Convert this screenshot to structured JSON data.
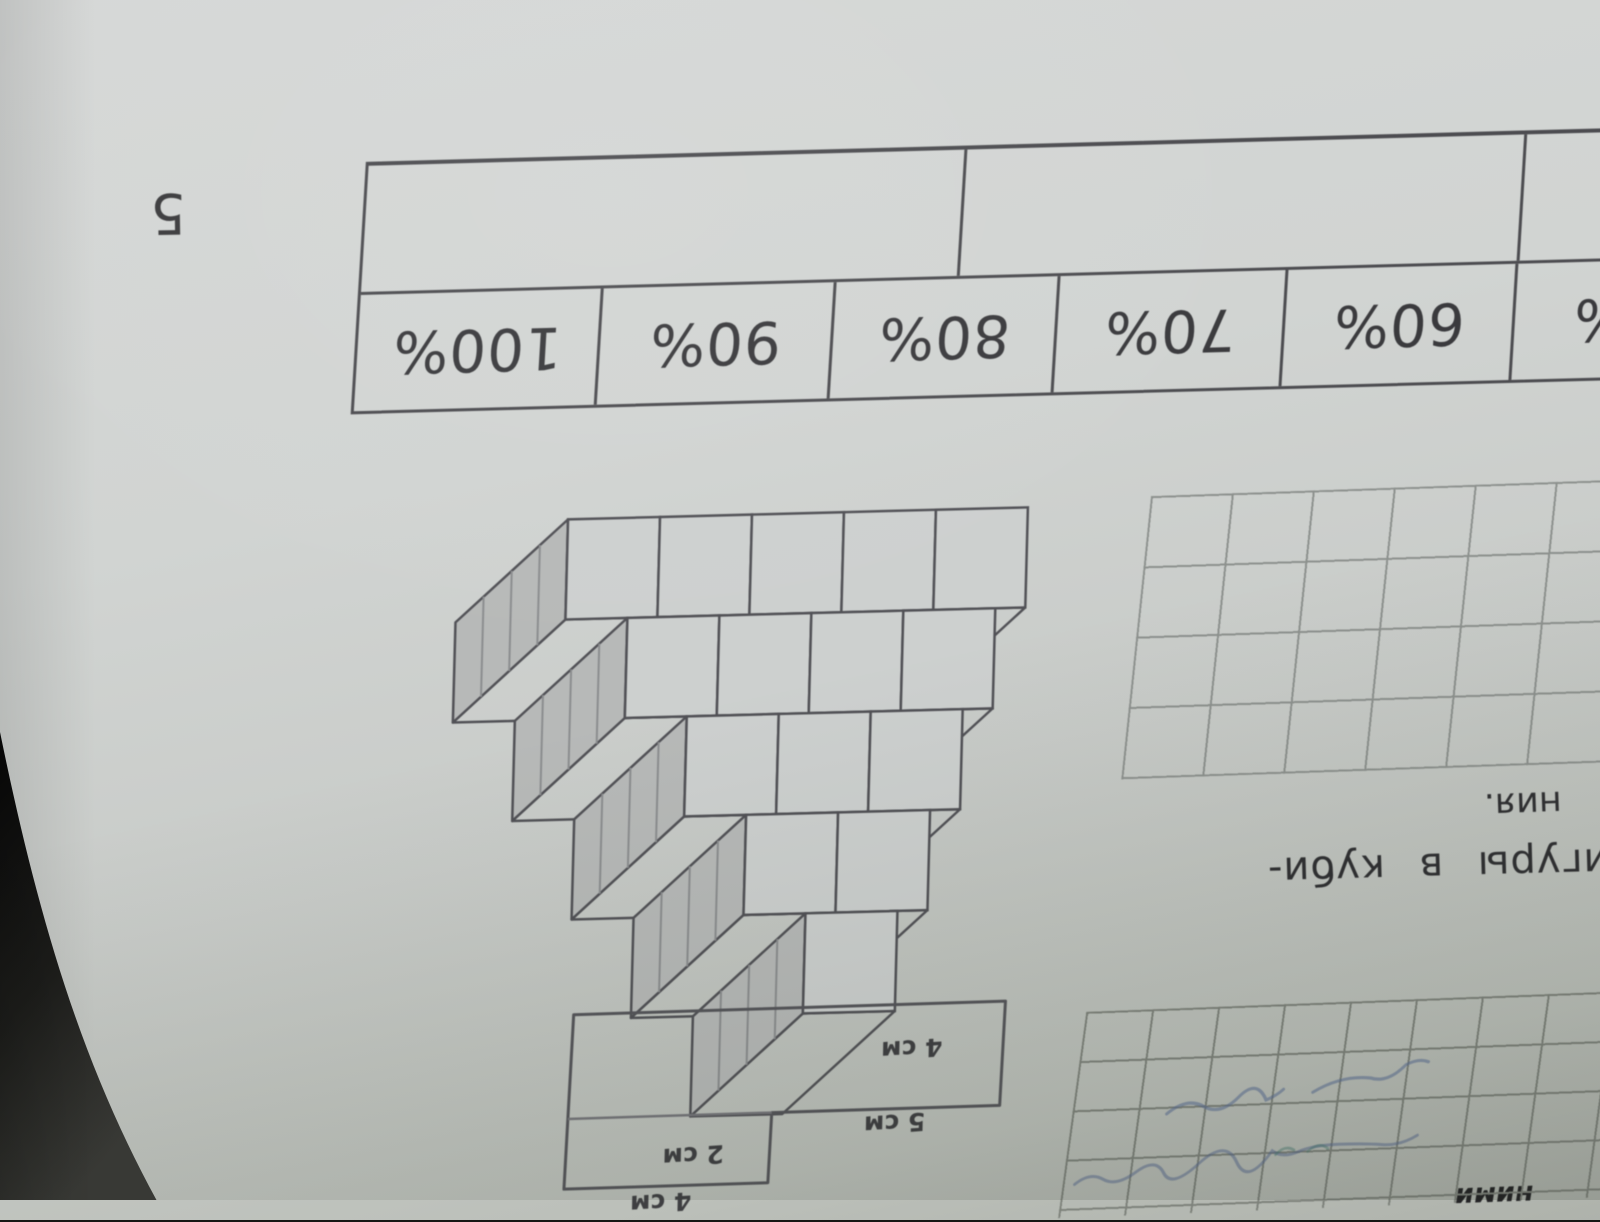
{
  "page": {
    "task_number": "5",
    "table": {
      "header_cells": [
        "",
        "",
        ""
      ],
      "percent_cells": [
        "100%",
        "90%",
        "80%",
        "70%",
        "60%",
        "50%"
      ]
    },
    "cube_figure": {
      "rows_of_cubes": [
        5,
        4,
        3,
        2,
        1
      ]
    },
    "grids": {
      "blank_grid": {
        "cols": 6,
        "rows": 4
      },
      "notebook_grid": {
        "cols": 9,
        "rows": 5
      }
    },
    "text_fragments": {
      "line_ending": "ния.",
      "hyphenated_line": "фигуры в куби-",
      "bottom_cut": "ними"
    },
    "lshape_labels": {
      "height": "4 см",
      "width_step": "5 см",
      "notch": "2 см",
      "bottom": "4 см"
    },
    "colors": {
      "paper": "#cdd0ce",
      "ink": "#39393c",
      "table_line": "#4c4c50",
      "grid_line": "#8d918e",
      "pen": "#5a6d96",
      "background": "#161614"
    }
  }
}
